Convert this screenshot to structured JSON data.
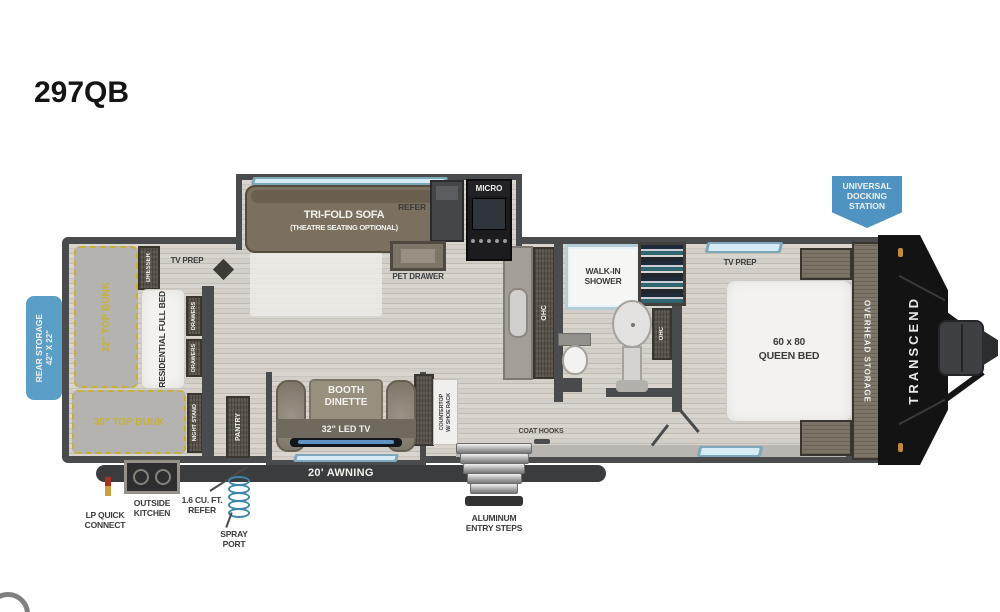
{
  "title": "297QB",
  "labels": {
    "sofa_line1": "TRI-FOLD SOFA",
    "sofa_line2": "(THEATRE SEATING OPTIONAL)",
    "refer": "REFER",
    "micro": "MICRO",
    "pet_drawer": "PET DRAWER",
    "dresser": "DRESSER",
    "tv_prep_bunk": "TV PREP",
    "bunk32": "32\" TOP BUNK",
    "full_bed": "RESIDENTIAL FULL BED",
    "drawers": "DRAWERS",
    "bunk30": "30\" TOP BUNK",
    "night_stand": "NIGHT STAND",
    "pantry": "PANTRY",
    "booth_line1": "BOOTH",
    "booth_line2": "DINETTE",
    "led_tv": "32\" LED TV",
    "countertop_line1": "COUNTERTOP",
    "countertop_line2": "W/ SHOE RACK",
    "ohc": "OHC",
    "shower_line1": "WALK-IN",
    "shower_line2": "SHOWER",
    "bed_size": "60 x 80",
    "bed_name": "QUEEN BED",
    "tv_prep_bed": "TV PREP",
    "overhead_storage": "OVERHEAD STORAGE",
    "brand": "TRANSCEND",
    "coat_hooks": "COAT HOOKS",
    "awning": "20' AWNING",
    "steps_line1": "ALUMINUM",
    "steps_line2": "ENTRY STEPS",
    "lp_line1": "LP QUICK",
    "lp_line2": "CONNECT",
    "ok_line1": "OUTSIDE",
    "ok_line2": "KITCHEN",
    "oref_line1": "1.6 CU. FT.",
    "oref_line2": "REFER",
    "spray_line1": "SPRAY",
    "spray_line2": "PORT",
    "rear_line1": "REAR STORAGE",
    "rear_line2": "42\" X 22\"",
    "dock_line1": "UNIVERSAL",
    "dock_line2": "DOCKING",
    "dock_line3": "STATION"
  },
  "colors": {
    "badge_blue": "#5b9fc6",
    "dock_blue": "#4f93c2",
    "bunk_yellow": "#c6b13e",
    "wall_gray": "#4a4b4d",
    "floor_wood": "#d6d2cb",
    "window_blue": "#d5ebf5",
    "front_cap": "#131313"
  }
}
